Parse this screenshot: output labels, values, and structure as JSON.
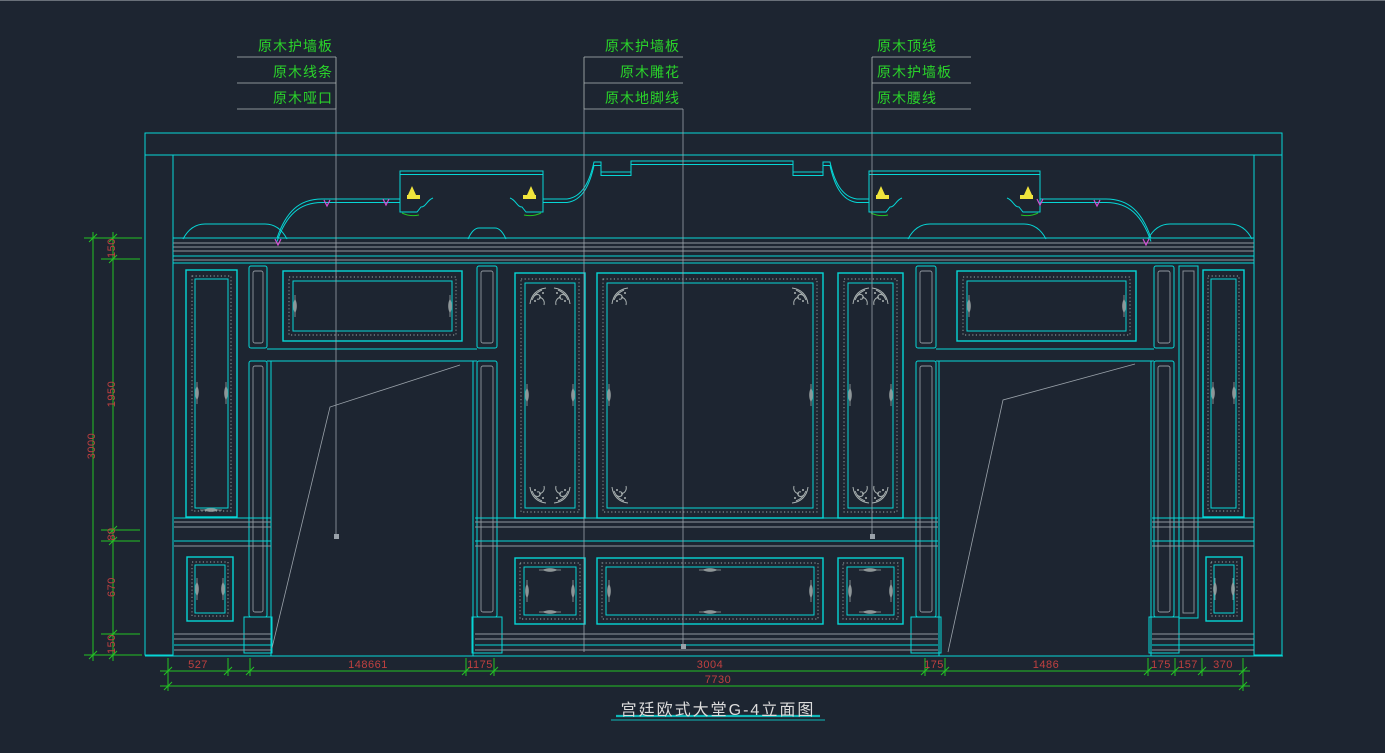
{
  "window": {
    "background": "#1d2531",
    "description": "CAD model-space elevation drawing"
  },
  "callouts": {
    "left_block": {
      "items": [
        "原木护墙板",
        "原木线条",
        "原木哑口"
      ]
    },
    "middle_block": {
      "items": [
        "原木护墙板",
        "原木雕花",
        "原木地脚线"
      ]
    },
    "right_block": {
      "items": [
        "原木顶线",
        "原木护墙板",
        "原木腰线"
      ]
    }
  },
  "dimensions": {
    "left_vertical": {
      "overall": "3000",
      "segments": [
        "150",
        "1950",
        "80",
        "670",
        "150"
      ]
    },
    "bottom_row": {
      "overall": "7730",
      "segments": [
        "527",
        "148661",
        "1175",
        "3004",
        "175",
        "1486",
        "175",
        "157",
        "370"
      ]
    }
  },
  "drawing_title": "宫廷欧式大堂G-4立面图",
  "colors": {
    "line_cyan": "#06d6d6",
    "dim_green": "#23c423",
    "dim_text_red": "#c04040",
    "callout_text_green": "#2ad42a",
    "ornament_gray": "#aab2b2",
    "accent_yellow": "#f0e43c",
    "accent_magenta": "#d24fd2",
    "hatch_gray": "#7f8b94",
    "title_white": "#dcdcdc"
  }
}
